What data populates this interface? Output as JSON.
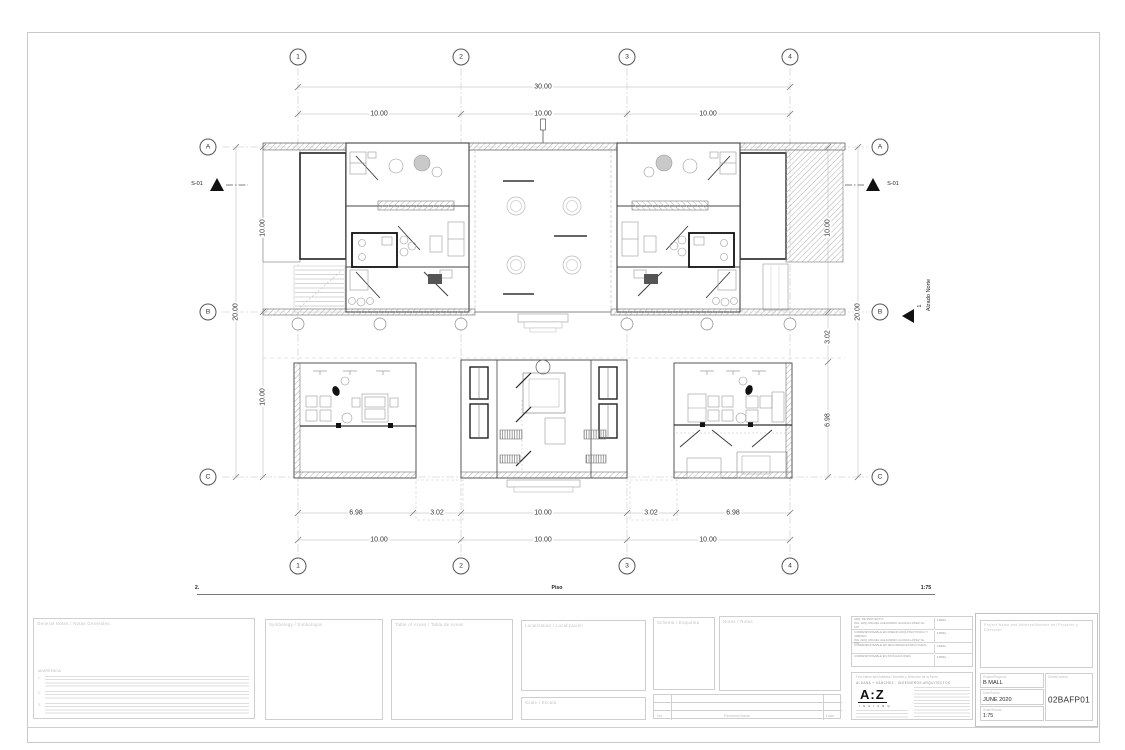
{
  "sheet": {
    "bottom_label_left": "2.",
    "bottom_label_center": "Piso",
    "bottom_label_right": "1:75"
  },
  "grid": {
    "columns": [
      "1",
      "2",
      "3",
      "4"
    ],
    "rows": [
      "A",
      "B",
      "C"
    ]
  },
  "dimensions": {
    "top_total": "30.00",
    "top_segments": [
      "10.00",
      "10.00",
      "10.00"
    ],
    "left": [
      "10.00",
      "20.00",
      "10.00"
    ],
    "right": [
      "10.00",
      "20.00",
      "3.02",
      "6.98"
    ],
    "bottom_inner": [
      "6.98",
      "3.02",
      "10.00",
      "3.02",
      "6.98"
    ],
    "bottom_outer": [
      "10.00",
      "10.00",
      "10.00"
    ]
  },
  "markers": {
    "section_left": "S-01",
    "section_right": "S-01",
    "elevation_number": "1",
    "elevation_label": "Alzado Norte"
  },
  "titleblock": {
    "notes": {
      "title": "General Notes / Notas Generales",
      "warning": "ADVERTENCIA:",
      "items": [
        "1.",
        "2.",
        "3."
      ]
    },
    "symbology_title": "Symbology / Simbología",
    "areas_title": "Table of Areas / Tabla de Areas",
    "localization_title": "Localization / Localización",
    "scale_box_title": "Scale / Escala",
    "schema_title": "Schema / Esquema",
    "notes2_title": "Notes / Notas",
    "revision": {
      "col_no": "No.",
      "col_rev": "Revision/Issue",
      "col_date": "Date"
    },
    "professionals": {
      "rows": [
        {
          "role": "ARQ. DE PROYECTO:",
          "name": "ING. ARQ. MIGUEL ALEJANDRO ALDANA LÓPEZ",
          "reg": "No. 678",
          "sign": "FIRMA"
        },
        {
          "role": "CORRESPONSABLE EN DISEÑO ARQUITECTÓNICO Y URBANO:",
          "name": "ING. ARQ. MIGUEL ALEJANDRO ALDANA LÓPEZ",
          "reg": "No. 678",
          "sign": "FIRMA"
        },
        {
          "role": "CORRESPONSABLE EN SEGURIDAD ESTRUCTURAL:",
          "name": "",
          "reg": "",
          "sign": "FIRMA"
        },
        {
          "role": "CORRESPONSABLE EN INSTALACIONES:",
          "name": "",
          "reg": "",
          "sign": "FIRMA"
        }
      ]
    },
    "firm": {
      "header": "Firm Name and Address / Nombre y Dirección de la Firma",
      "name": "ALDANA + SÁNCHEZ - INGENIEROS ARQUITECTOS",
      "logo": "A:Z",
      "logo_sub": "I N G I A R Q"
    },
    "project": {
      "header": "Project Name and Address/Nombre del Proyecto y Dirección",
      "project_label": "Project/Proyecto",
      "project_value": "B MALL",
      "date_label": "Date/Fecha",
      "date_value": "JUNE 2020",
      "scale_label": "Scale/Escala",
      "scale_value": "1:75",
      "sheet_label": "Sheet/Lámina",
      "sheet_value": "02BAFP01"
    }
  }
}
